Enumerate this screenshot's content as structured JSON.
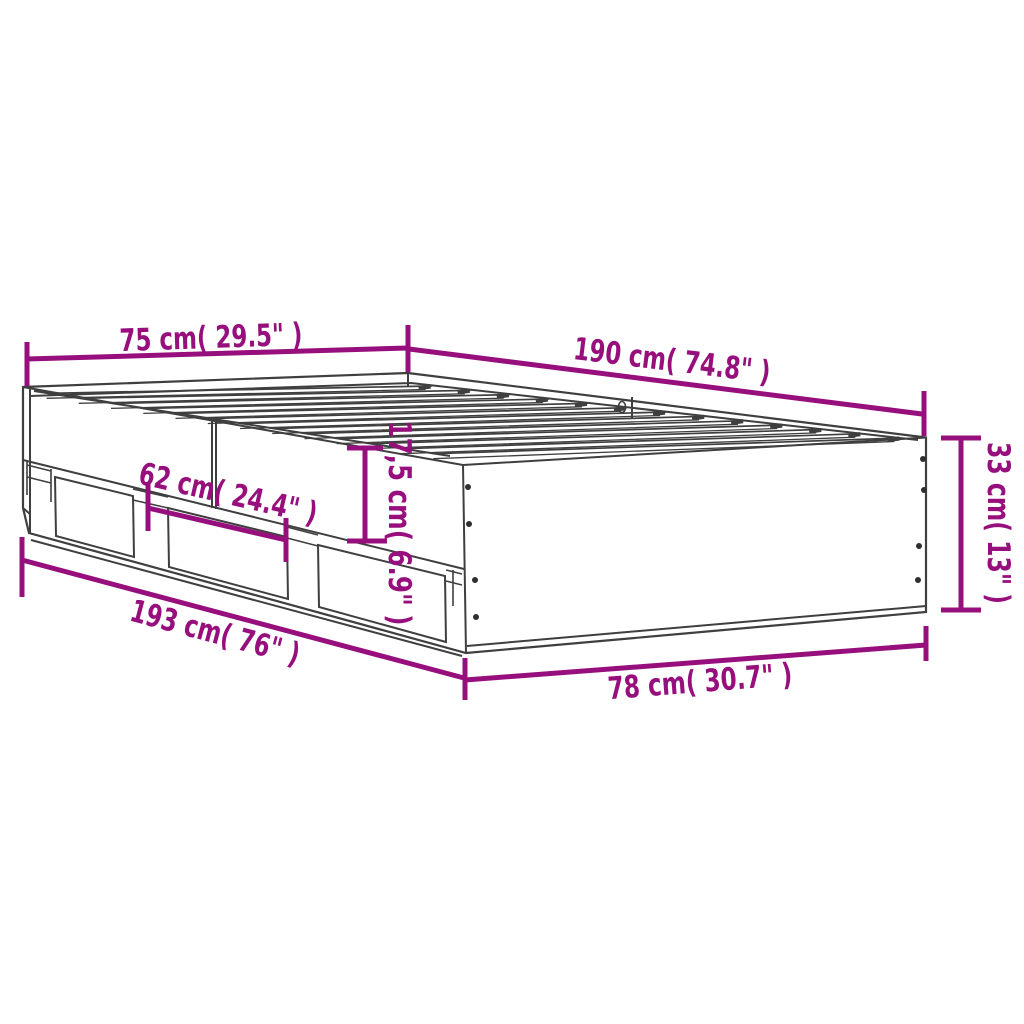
{
  "title": "Bed frame with three drawers - dimension diagram",
  "colors": {
    "dimension": "#970f7d",
    "outline": "#3f3f3f",
    "screw": "#2e2e2e",
    "background": "#ffffff"
  },
  "labels": {
    "top_width": "75 cm( 29.5\" )",
    "top_length": "190 cm( 74.8\" )",
    "side_height": "33 cm( 13\" )",
    "rail_height": "17,5 cm( 6.9\" )",
    "drawer_width": "62 cm( 24.4\" )",
    "bottom_length": "193 cm( 76\" )",
    "bottom_width": "78 cm( 30.7\" )"
  },
  "dimensions": [
    {
      "part": "slat-surface-width",
      "cm": "75",
      "inch": "29.5"
    },
    {
      "part": "slat-surface-length",
      "cm": "190",
      "inch": "74.8"
    },
    {
      "part": "frame-height",
      "cm": "33",
      "inch": "13"
    },
    {
      "part": "side-rail-height",
      "cm": "17,5",
      "inch": "6.9"
    },
    {
      "part": "drawer-width",
      "cm": "62",
      "inch": "24.4"
    },
    {
      "part": "overall-length",
      "cm": "193",
      "inch": "76"
    },
    {
      "part": "overall-width",
      "cm": "78",
      "inch": "30.7"
    }
  ]
}
